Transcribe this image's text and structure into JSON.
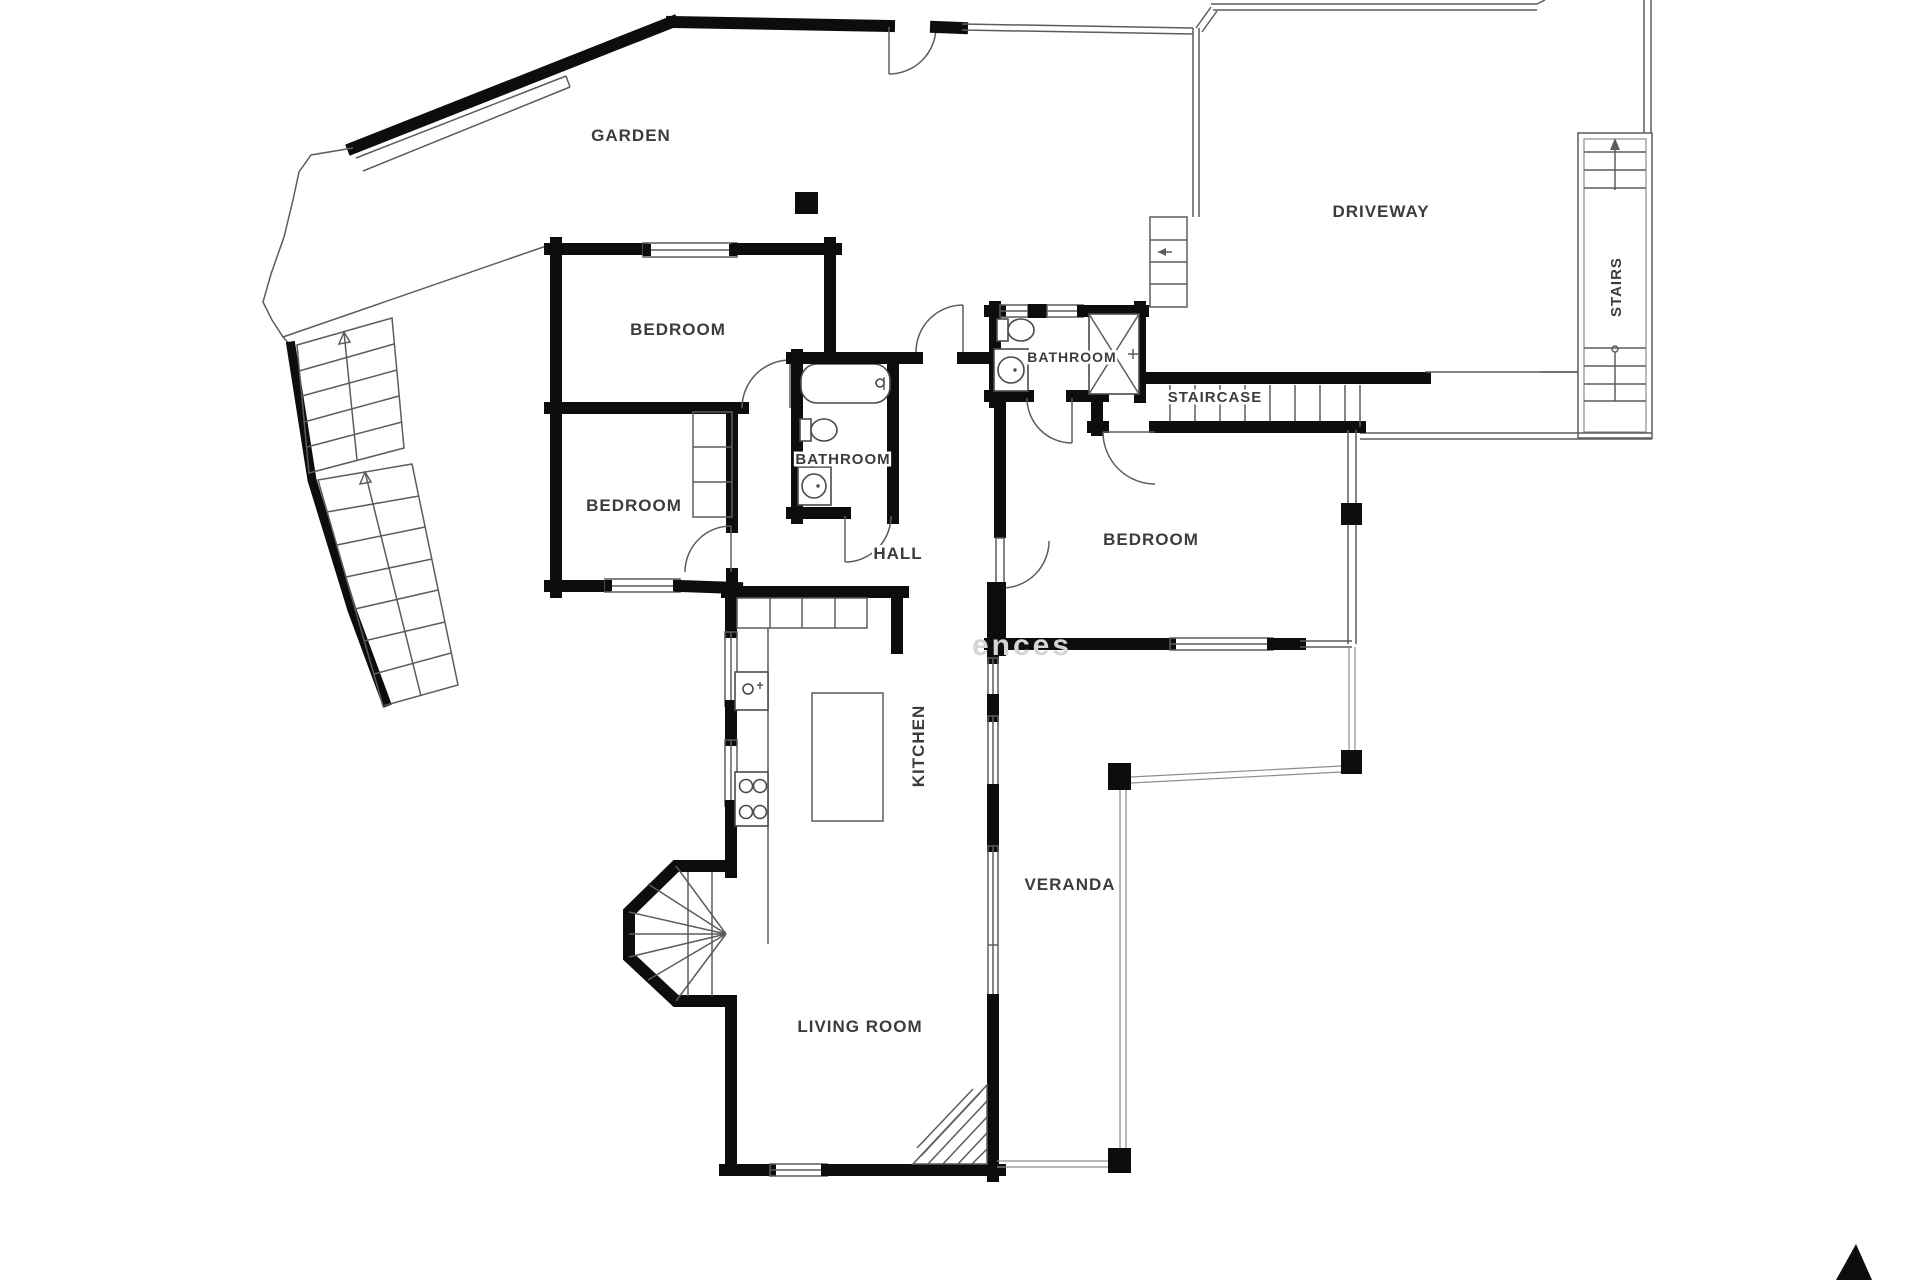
{
  "document": {
    "type": "floor-plan",
    "style": "black-and-white architectural drawing"
  },
  "colors": {
    "background": "#ffffff",
    "wall": "#0d0d0d",
    "thin_line": "#5c5c5c",
    "label": "#3c3c3c",
    "watermark": "#d4d4d4"
  },
  "rooms": [
    {
      "id": "garden",
      "label": "GARDEN"
    },
    {
      "id": "driveway",
      "label": "DRIVEWAY"
    },
    {
      "id": "stairs-ext",
      "label": "STAIRS"
    },
    {
      "id": "bedroom-1",
      "label": "BEDROOM"
    },
    {
      "id": "bathroom-top",
      "label": "BATHROOM"
    },
    {
      "id": "staircase",
      "label": "STAIRCASE"
    },
    {
      "id": "bedroom-2",
      "label": "BEDROOM"
    },
    {
      "id": "bathroom-main",
      "label": "BATHROOM"
    },
    {
      "id": "hall",
      "label": "HALL"
    },
    {
      "id": "bedroom-3",
      "label": "BEDROOM"
    },
    {
      "id": "kitchen",
      "label": "KITCHEN"
    },
    {
      "id": "veranda",
      "label": "VERANDA"
    },
    {
      "id": "living-room",
      "label": "LIVING ROOM"
    }
  ],
  "watermark": {
    "text": "ences"
  },
  "logo": {
    "shape": "black-triangle"
  }
}
